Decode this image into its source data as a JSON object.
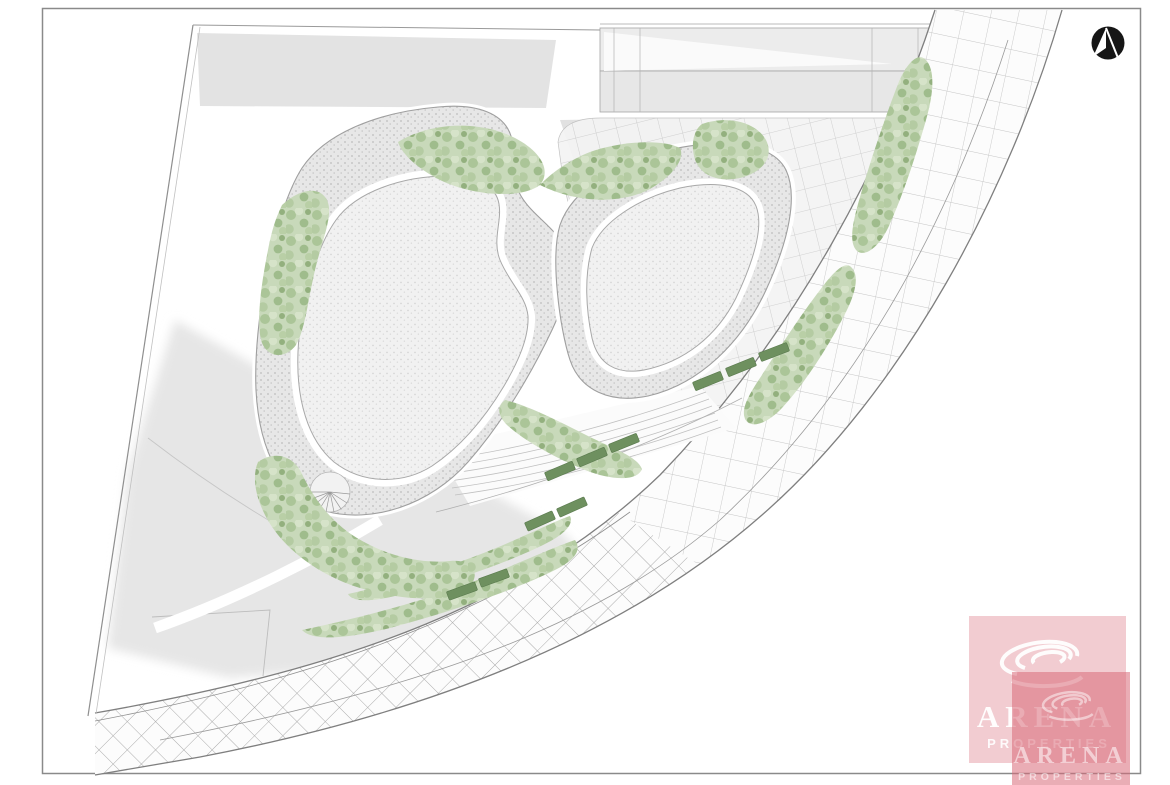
{
  "document": {
    "type": "architectural-site-plan",
    "background": "#ffffff",
    "frame_stroke": "#8a8a8a"
  },
  "compass": {
    "icon": "north-arrow-icon",
    "fill": "#161616",
    "arrow_color": "#ffffff"
  },
  "watermark": {
    "brand": "ARENA",
    "brand_sub": "PROPERTIES",
    "brand_color": "#d96a78",
    "text_color": "#ffffff",
    "icon": "arena-swirl-icon",
    "instances": 2
  },
  "legend": {
    "vegetation_color": "#b7cda6",
    "bench_color": "#6e905f",
    "roof_stipple_color": "#e7e7e7",
    "inner_roof_color": "#f0f0f0",
    "shadow_color": "#e6e6e6",
    "paving_line_color": "#c6c6c6",
    "boundary_line_color": "#8f8f8f"
  }
}
